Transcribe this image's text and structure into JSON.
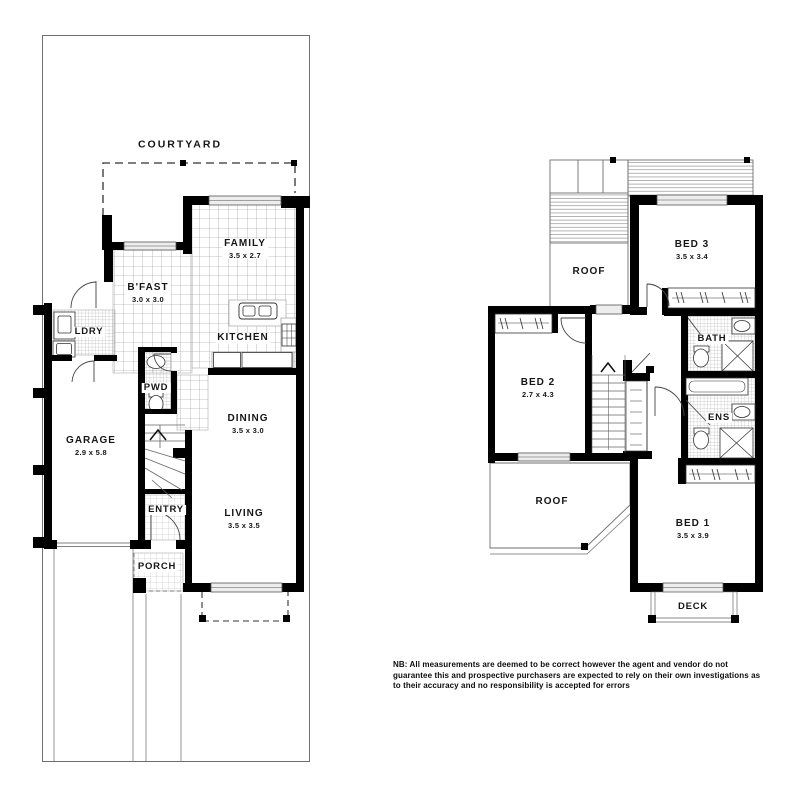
{
  "document": {
    "type": "real-estate floor plan",
    "floors": [
      "ground",
      "upper"
    ]
  },
  "colors": {
    "wall": "#000000",
    "thin_line": "#6e6e6e",
    "dash_line": "#333333",
    "window_fill": "#ededed",
    "background": "#ffffff"
  },
  "ground_floor": {
    "rooms": [
      {
        "id": "courtyard",
        "label": "COURTYARD",
        "dims": ""
      },
      {
        "id": "family",
        "label": "FAMILY",
        "dims": "3.5 x 2.7"
      },
      {
        "id": "bfast",
        "label": "B'FAST",
        "dims": "3.0 x 3.0"
      },
      {
        "id": "ldry",
        "label": "LDRY",
        "dims": ""
      },
      {
        "id": "kitchen",
        "label": "KITCHEN",
        "dims": ""
      },
      {
        "id": "pwd",
        "label": "PWD",
        "dims": ""
      },
      {
        "id": "dining",
        "label": "DINING",
        "dims": "3.5 x 3.0"
      },
      {
        "id": "garage",
        "label": "GARAGE",
        "dims": "2.9 x 5.8"
      },
      {
        "id": "entry",
        "label": "ENTRY",
        "dims": ""
      },
      {
        "id": "living",
        "label": "LIVING",
        "dims": "3.5 x 3.5"
      },
      {
        "id": "porch",
        "label": "PORCH",
        "dims": ""
      }
    ]
  },
  "upper_floor": {
    "rooms": [
      {
        "id": "roof-upper",
        "label": "ROOF",
        "dims": ""
      },
      {
        "id": "bed3",
        "label": "BED 3",
        "dims": "3.5 x 3.4"
      },
      {
        "id": "bath",
        "label": "BATH",
        "dims": ""
      },
      {
        "id": "bed2",
        "label": "BED 2",
        "dims": "2.7 x 4.3"
      },
      {
        "id": "ens",
        "label": "ENS",
        "dims": ""
      },
      {
        "id": "roof-lower",
        "label": "ROOF",
        "dims": ""
      },
      {
        "id": "bed1",
        "label": "BED 1",
        "dims": "3.5 x 3.9"
      },
      {
        "id": "deck",
        "label": "DECK",
        "dims": ""
      }
    ]
  },
  "disclaimer": {
    "lines": [
      "NB: All measurements are deemed to be correct however the agent and vendor do not",
      "guarantee this and prospective purchasers are expected to rely on their own investigations as",
      "to their accuracy and no responsibility is accepted for errors"
    ]
  }
}
